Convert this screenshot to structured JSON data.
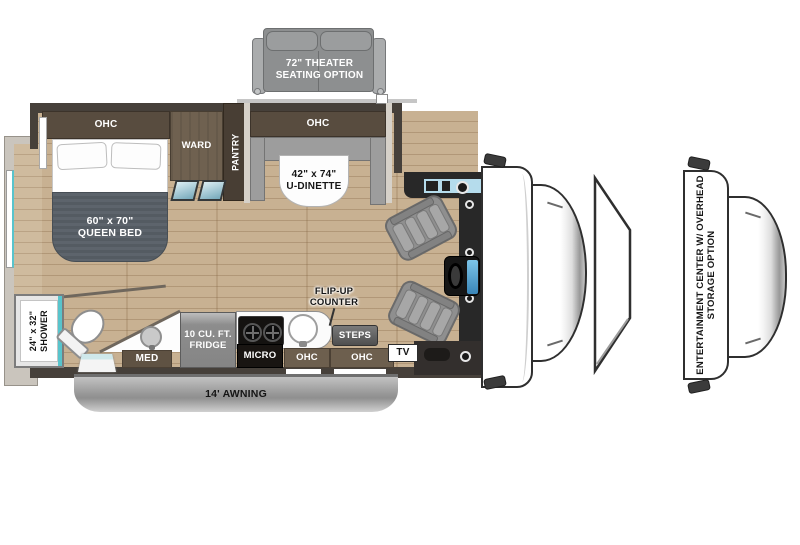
{
  "floorplan": {
    "title": "RV floor plan with options",
    "options": {
      "theater_seating": {
        "line1": "72\" THEATER",
        "line2": "SEATING OPTION"
      },
      "entertainment_center": {
        "line1": "ENTERTAINMENT CENTER W/ OVERHEAD",
        "line2": "STORAGE OPTION"
      }
    },
    "bedroom": {
      "ohc": "OHC",
      "ward": "WARD",
      "pantry": "PANTRY",
      "bed_line1": "60\" x 70\"",
      "bed_line2": "QUEEN BED"
    },
    "dinette": {
      "ohc": "OHC",
      "line1": "42\" x 74\"",
      "line2": "U-DINETTE"
    },
    "bathroom": {
      "shower_line1": "24\" x 32\"",
      "shower_line2": "SHOWER",
      "med": "MED"
    },
    "kitchen": {
      "fridge_line1": "10 CU. FT.",
      "fridge_line2": "FRIDGE",
      "micro": "MICRO",
      "flip_up_line1": "FLIP-UP",
      "flip_up_line2": "COUNTER",
      "ohc": "OHC"
    },
    "entry": {
      "steps": "STEPS",
      "ohc": "OHC"
    },
    "cab": {
      "tv": "TV"
    },
    "exterior": {
      "awning": "14' AWNING"
    },
    "colors": {
      "wall": "#46403a",
      "floor_wood": "#c8b192",
      "cabinet_dark": "#584c3f",
      "cabinet_brown": "#6d5f4e",
      "ward_wood": "#6f6150",
      "bench_gray": "#9d9d9d",
      "glass_teal": "#58c4cc",
      "windshield_blue": "#b5dcec",
      "dash_dark": "#262626",
      "awning_gray": "#a9a9a9"
    }
  }
}
